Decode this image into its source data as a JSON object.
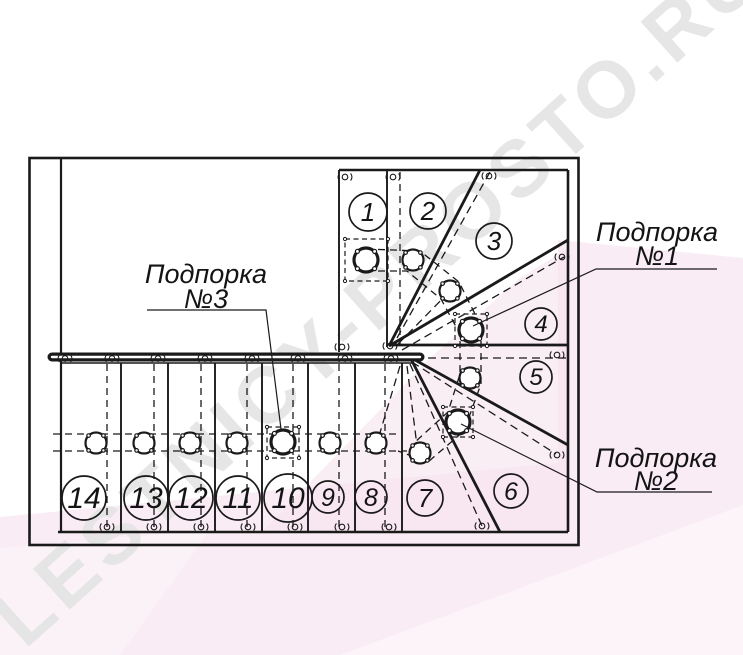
{
  "watermark": {
    "text": "LESTNICY-PROSTO.RU",
    "text_color": "#e4e4e4",
    "band_color": "#f6e2ee"
  },
  "colors": {
    "line": "#1a1a1a",
    "background": "#ffffff",
    "pink_light": "#f9ecf4"
  },
  "labels": {
    "support1": {
      "name": "Подпорка",
      "number": "№1"
    },
    "support2": {
      "name": "Подпорка",
      "number": "№2"
    },
    "support3": {
      "name": "Подпорка",
      "number": "№3"
    }
  },
  "steps": [
    "1",
    "2",
    "3",
    "4",
    "5",
    "6",
    "7",
    "8",
    "9",
    "10",
    "11",
    "12",
    "13",
    "14"
  ]
}
